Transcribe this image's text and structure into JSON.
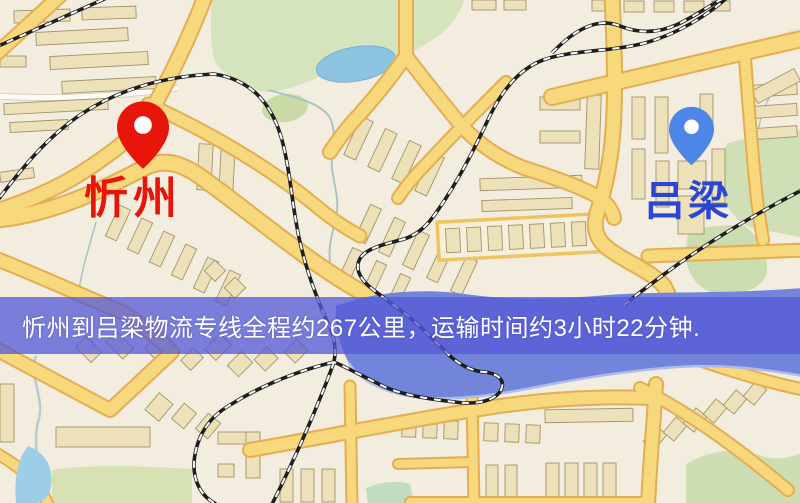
{
  "map": {
    "markers": {
      "origin": {
        "label": "忻州",
        "pin_color": "#e8150b",
        "label_color": "#e8150b"
      },
      "destination": {
        "label": "吕梁",
        "pin_color": "#4e86e8",
        "label_color": "#2c46d4"
      }
    },
    "banner": {
      "text": "忻州到吕梁物流专线全程约267公里，运输时间约3小时22分钟.",
      "background_color": "#585cd7",
      "text_color": "#ffffff"
    },
    "theme": {
      "land": "#f0ebdd",
      "park": "#d4e4bc",
      "pond": "#8cc4e2",
      "river": "#7285da",
      "road_fill": "#f8d87d",
      "road_casing": "#e3ad52",
      "building_fill": "#ece1b8",
      "building_stroke": "#a3936a",
      "railway": "#1e1e1e"
    }
  }
}
